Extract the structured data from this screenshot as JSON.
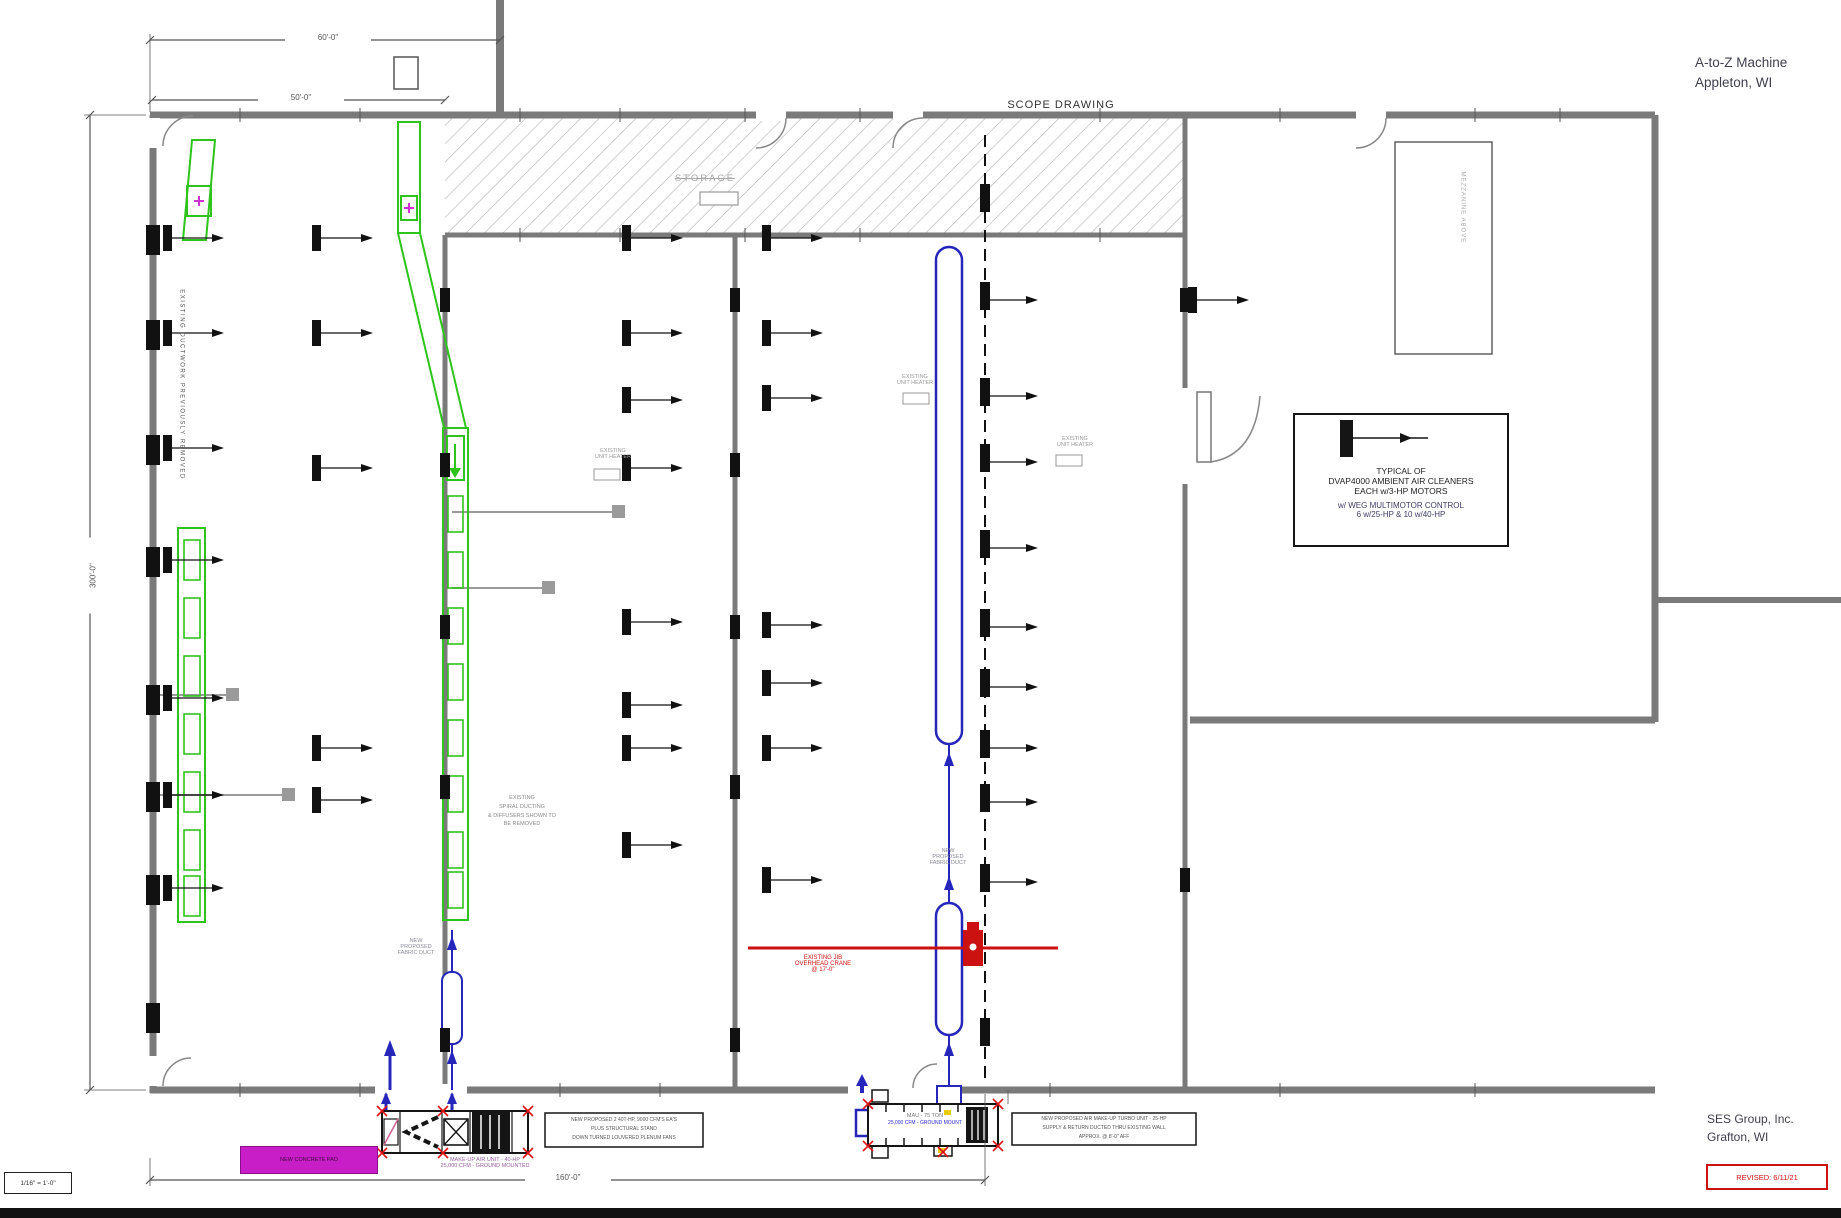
{
  "title_block": {
    "client_name": "A-to-Z Machine",
    "client_city": "Appleton, WI",
    "drawing_title": "SCOPE DRAWING",
    "firm_name": "SES Group, Inc.",
    "firm_city": "Grafton, WI",
    "revision": "REVISED: 6/11/21",
    "scale": "1/16\" = 1'-0\""
  },
  "dimensions": {
    "top_overall": "60'-0\"",
    "top_inner": "50'-0\"",
    "left_overall": "300'-0\"",
    "bottom_overall": "160'-0\""
  },
  "labels": {
    "storage": "STORAGE",
    "left_wall_note": "EXISTING DUCTWORK PREVIOUSLY REMOVED",
    "mezzanine_note": "MEZZANINE ABOVE",
    "unit_heater": [
      "EXISTING",
      "UNIT HEATER"
    ],
    "pad": "NEW CONCRETE PAD"
  },
  "notes": {
    "typical_box": [
      "TYPICAL OF",
      "DVAP4000 AMBIENT AIR CLEANERS",
      "EACH w/3-HP MOTORS",
      "w/ WEG MULTIMOTOR CONTROL",
      "6 w/25-HP & 10 w/40-HP"
    ],
    "spiral_duct": [
      "EXISTING",
      "SPIRAL DUCTING",
      "& DIFFUSERS SHOWN TO",
      "BE REMOVED"
    ],
    "fabric_duct": [
      "NEW",
      "PROPOSED",
      "FABRIC DUCT"
    ],
    "crane": [
      "EXISTING JIB",
      "OVERHEAD CRANE",
      "@ 17'-0\""
    ],
    "unit1_caption": [
      "MAKE-UP AIR UNIT - 40-HP",
      "25,000 CFM - GROUND MOUNTED"
    ],
    "unit1_box": [
      "NEW PROPOSED 2 40T-HP, 9000 CFM'S EA'S",
      "PLUS STRUCTURAL STAND",
      "DOWN TURNED LOUVERED PLENUM FANS"
    ],
    "unit2_line1": "MAU - 75 TON",
    "unit2_line2": "25,000 CFM - GROUND MOUNT",
    "unit2_box": [
      "NEW PROPOSED AIR MAKE-UP TURBO UNIT - 25-HP",
      "SUPPLY & RETURN DUCTED THRU EXISTING WALL",
      "APPROX. @ 8'-0\" AFF"
    ]
  },
  "colors": {
    "existing_duct_green": "#2ec41c",
    "new_duct_blue": "#2626bb",
    "highlight_magenta": "#c81ec8",
    "alert_red": "#cc1111",
    "wall_gray": "#7a7a7a"
  }
}
